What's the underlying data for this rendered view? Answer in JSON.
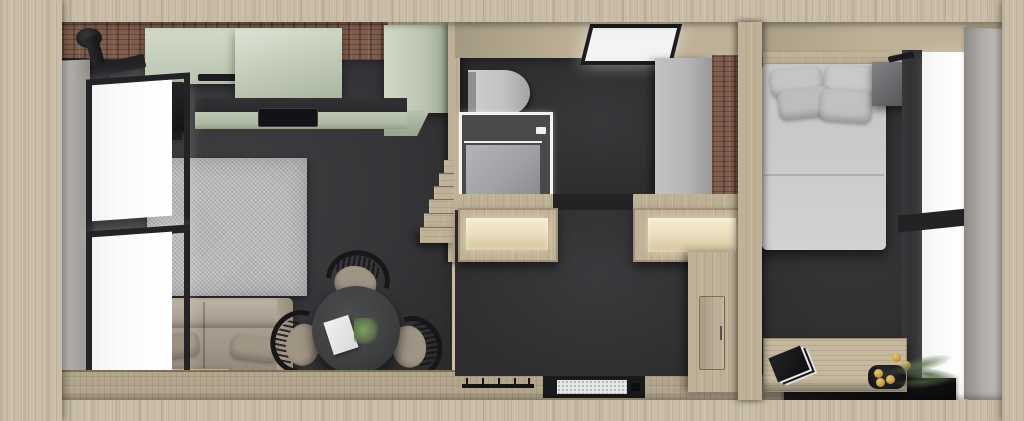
{
  "image": {
    "kind": "3D rendered top-down floor plan of a small cabin apartment",
    "width_px": 1024,
    "height_px": 421
  },
  "palette": {
    "outer_wood": "#c9bda8",
    "inner_wood": "#beb197",
    "floor_wood": "#b3a68e",
    "brick": "#7f5e4f",
    "dark_floor": "#353538",
    "dark_wall": "#2e2e30",
    "sage_cabinet": "#c6cfbc",
    "sage_counter": "#aeb8a3",
    "counter_top": "#29292b",
    "stove_black": "#202022",
    "rug_gray": "#b5b6b8",
    "sofa_taupe": "#a4988a",
    "table_dark": "#3f4042",
    "chair_black": "#17171a",
    "seat_taupe": "#a09484",
    "window_glass": "#fbfbfa",
    "frame_black": "#232326",
    "curtain_gray": "#b0aca7",
    "toilet_white": "#c2c3c5",
    "shower_gray": "#9fa0a3",
    "cabinet_gray": "#b6b6b8",
    "bench_glow": "#ecdfc0",
    "duvet_gray": "#cbcac8",
    "mat_white": "#e8e8e6",
    "panel_black": "#141416",
    "plant_green": "#5e7050",
    "gold": "#c49a42",
    "skylight_white": "#f2f3f2"
  },
  "scene": {
    "rooms": [
      {
        "label": "Living room and kitchen",
        "contents": [
          "sage upper kitchen cabinets",
          "tall sage cabinet",
          "brick wall strip",
          "black wood stove with flue pipe",
          "kitchen counter with black cooktop",
          "gray area rug",
          "taupe sofa with two pillows",
          "low bookshelf with books and plant",
          "round black dining table",
          "three spindle chairs",
          "paper sheet on table",
          "green plant on table",
          "arc lamp",
          "two black framed windows",
          "gray curtain"
        ]
      },
      {
        "label": "Bathroom",
        "contents": [
          "skylight in wood ceiling",
          "toilet",
          "walk-in shower with white frame",
          "tall gray storage cabinet",
          "brick accent wall",
          "small wood stair steps"
        ]
      },
      {
        "label": "Hallway / entry",
        "contents": [
          "two illuminated wardrobe bench niches",
          "wood partition with bedroom door",
          "entry doormat",
          "black coat hook rail"
        ]
      },
      {
        "label": "Bedroom",
        "contents": [
          "double bed with gray duvet and four pillows",
          "wood headboard shelf",
          "gray speaker box",
          "black framed window",
          "gray curtain panel",
          "wood sideboard with black books, tray and gold candles",
          "green plant",
          "glossy black floor panel"
        ]
      }
    ]
  }
}
